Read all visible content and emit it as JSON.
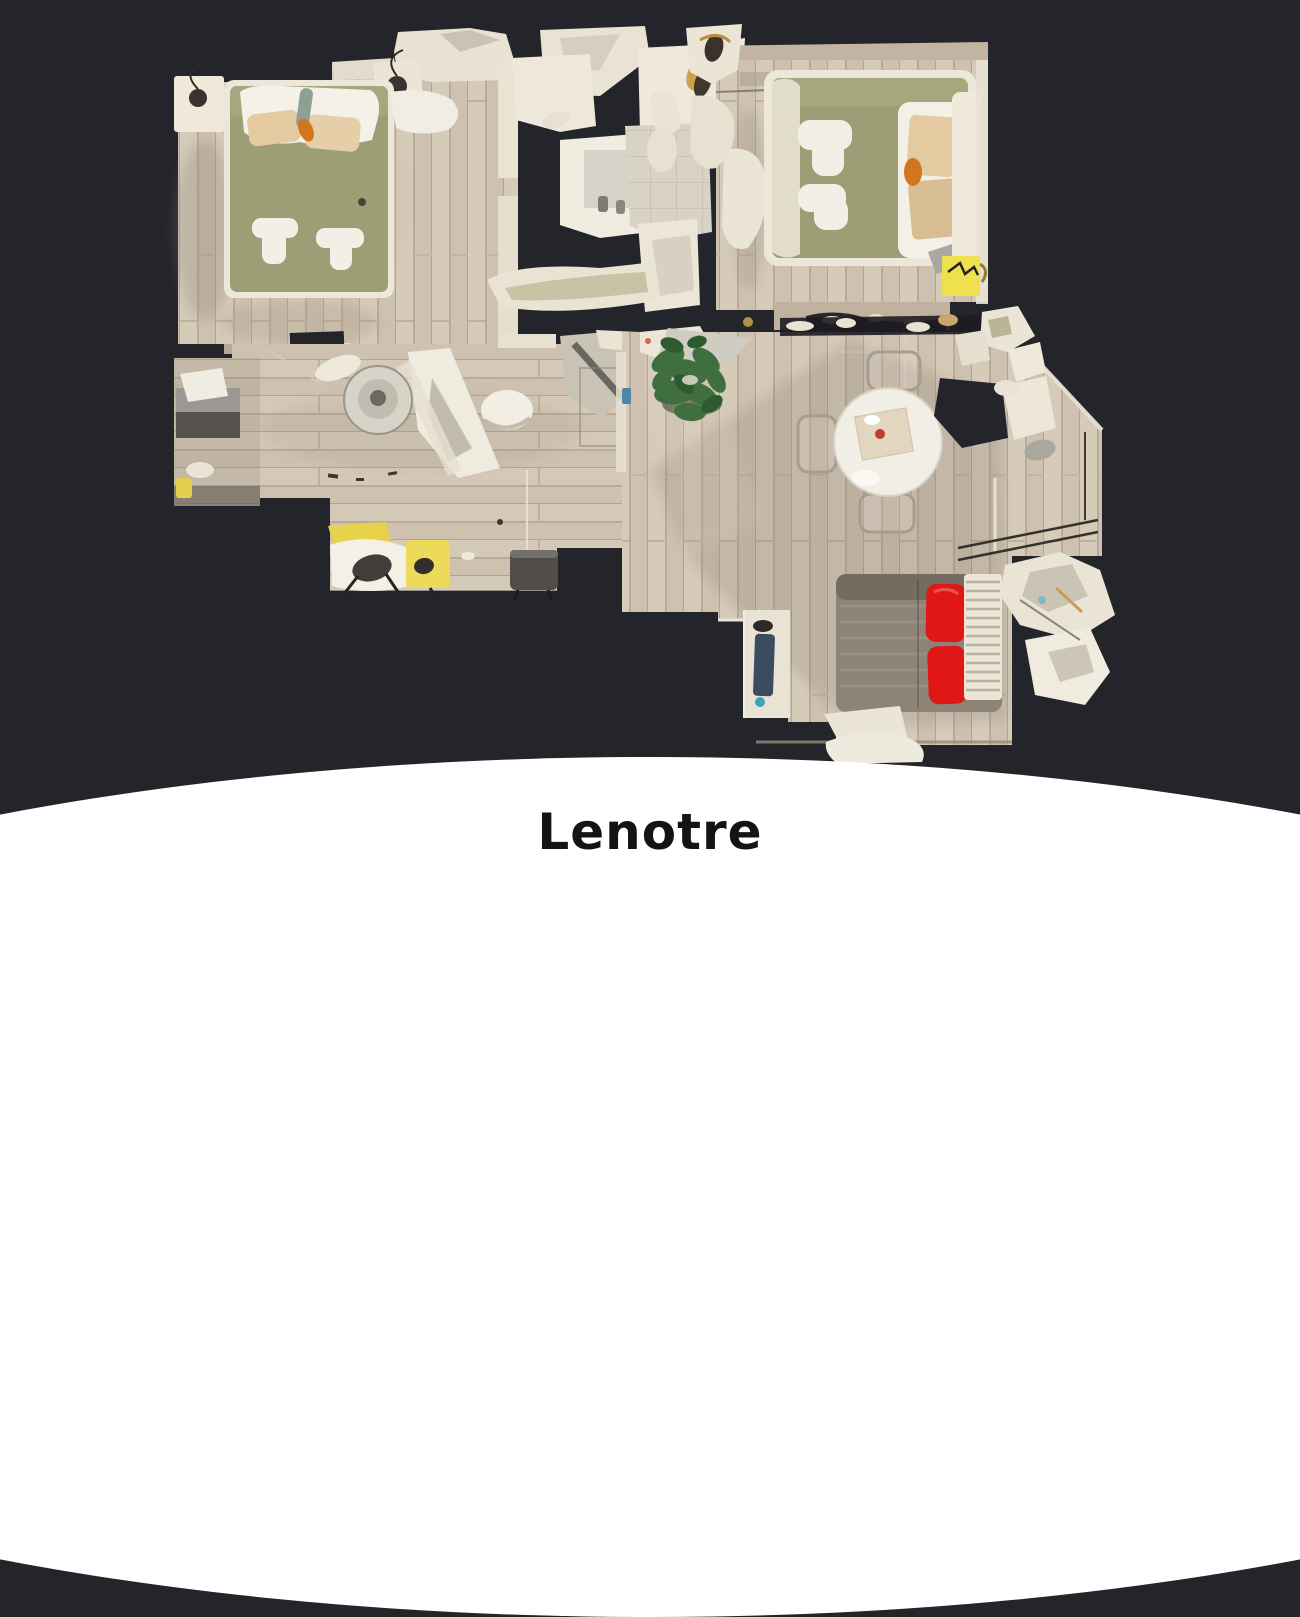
{
  "title": {
    "text": "Lenotre"
  },
  "page": {
    "background": "#24252a"
  },
  "footer": {
    "background": "#ffffff",
    "text_color": "#141414",
    "shape": "white-ellipse-band"
  },
  "floorplan": {
    "kind": "3d-dollhouse-top-down-scan",
    "colors": {
      "floor_wood": "#cfc2b0",
      "wall_ivory": "#ece6d8",
      "bed_olive": "#9e9e76",
      "pillow_beige": "#e3caa1",
      "linen_white": "#f3f0e8",
      "accent_orange": "#d2751e",
      "accent_yellow": "#efe14e",
      "sofa_gray": "#8e8377",
      "cushion_red": "#e11717",
      "plant_green": "#3f6f3f",
      "tile": "#d9d3c5"
    },
    "rooms": [
      {
        "id": "bedroom-left",
        "items": [
          "double-bed",
          "white-pillows",
          "beige-pillows",
          "two-folded-towels",
          "nightstand-lamp-left",
          "nightstand-lamp-top"
        ]
      },
      {
        "id": "bathroom-center",
        "items": [
          "shower",
          "sink-counter",
          "bathtub",
          "tiled-floor"
        ]
      },
      {
        "id": "bedroom-right",
        "items": [
          "double-bed",
          "beige-pillows",
          "two-folded-towels",
          "yellow-mat"
        ]
      },
      {
        "id": "entry-hallway",
        "items": [
          "dark-cabinet",
          "round-metal-table",
          "door-fragment",
          "white-chair"
        ]
      },
      {
        "id": "kitchen-corner",
        "items": [
          "yellow-chair",
          "white-seat",
          "gray-chair"
        ]
      },
      {
        "id": "living-dining",
        "items": [
          "round-dining-table",
          "dining-chairs",
          "potted-plant",
          "gray-sofa",
          "red-cushions",
          "radiator",
          "stair-rail"
        ]
      }
    ]
  }
}
